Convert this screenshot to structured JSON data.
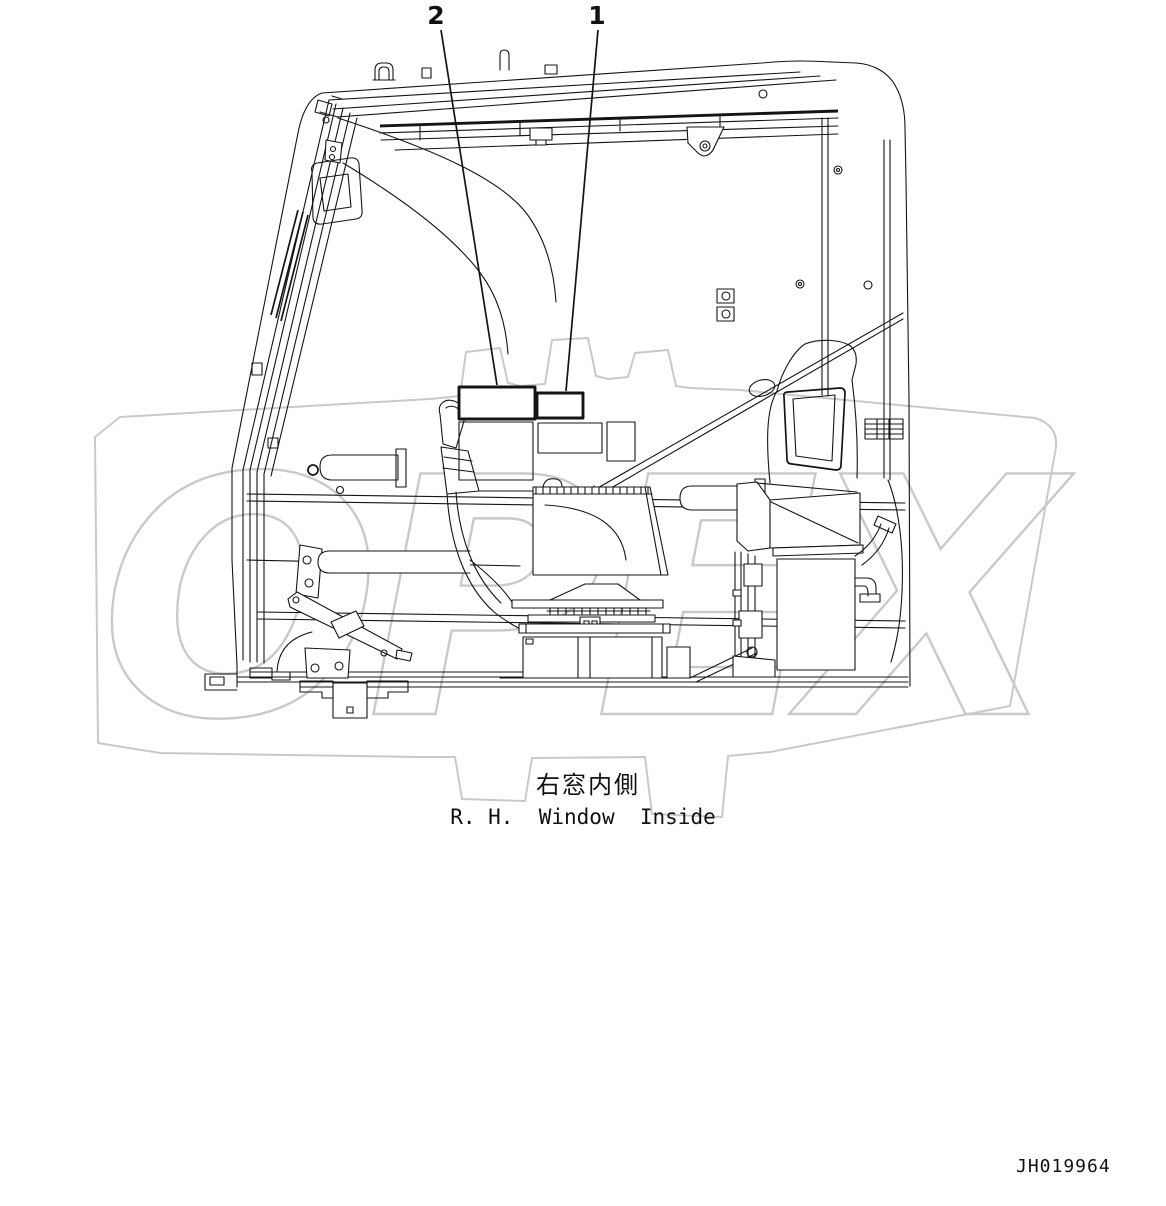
{
  "figure": {
    "type": "parts-location-diagram",
    "callouts": [
      {
        "id": "callout-2",
        "label": "2"
      },
      {
        "id": "callout-1",
        "label": "1"
      }
    ],
    "captions": {
      "japanese": "右窓内側",
      "english": "R. H.  Window  Inside"
    },
    "drawing_number": "JH019964",
    "watermark": {
      "text": "OPEX",
      "color": "#c9c9c9"
    },
    "colors": {
      "line": "#141414",
      "background": "#ffffff"
    }
  }
}
